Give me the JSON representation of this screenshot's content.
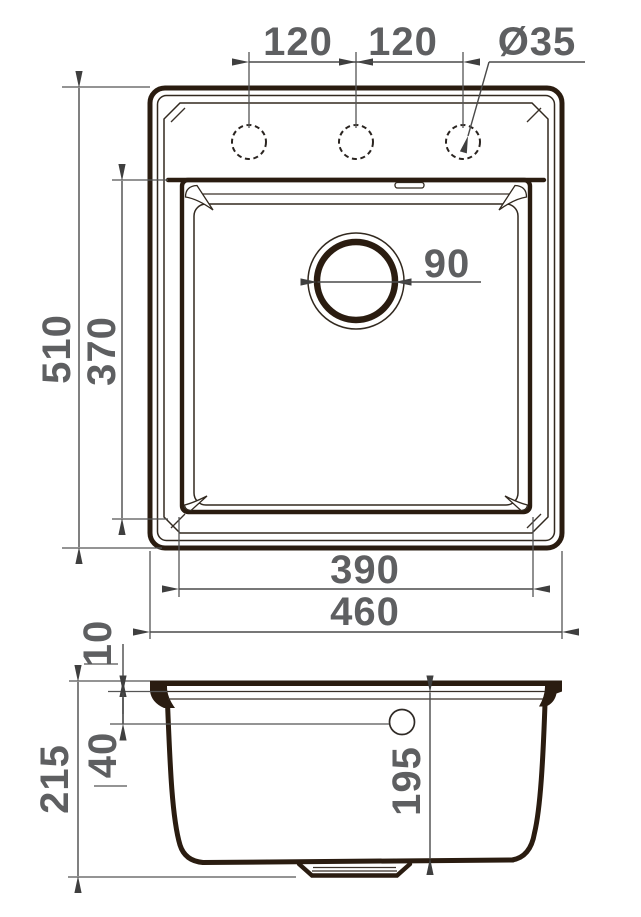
{
  "drawing": {
    "title": "sink-dimension-drawing",
    "labels": {
      "hole_spacing_left": "120",
      "hole_spacing_right": "120",
      "hole_diameter": "Ø35",
      "drain_diameter": "90",
      "overall_height": "510",
      "bowl_length": "370",
      "bowl_width": "390",
      "overall_width": "460",
      "rim_thickness": "10",
      "rim_to_overflow": "40",
      "overall_depth": "215",
      "bowl_depth": "195"
    },
    "colors": {
      "outline": "#2a1c10",
      "thin_line": "#32291f",
      "dimension_line": "#4a4a4a",
      "dimension_text": "#5e5f61",
      "background": "#ffffff"
    },
    "views": {
      "top_view": "plan view with three faucet holes and drain",
      "section_view": "front section with bowl depth and drain boss"
    }
  }
}
